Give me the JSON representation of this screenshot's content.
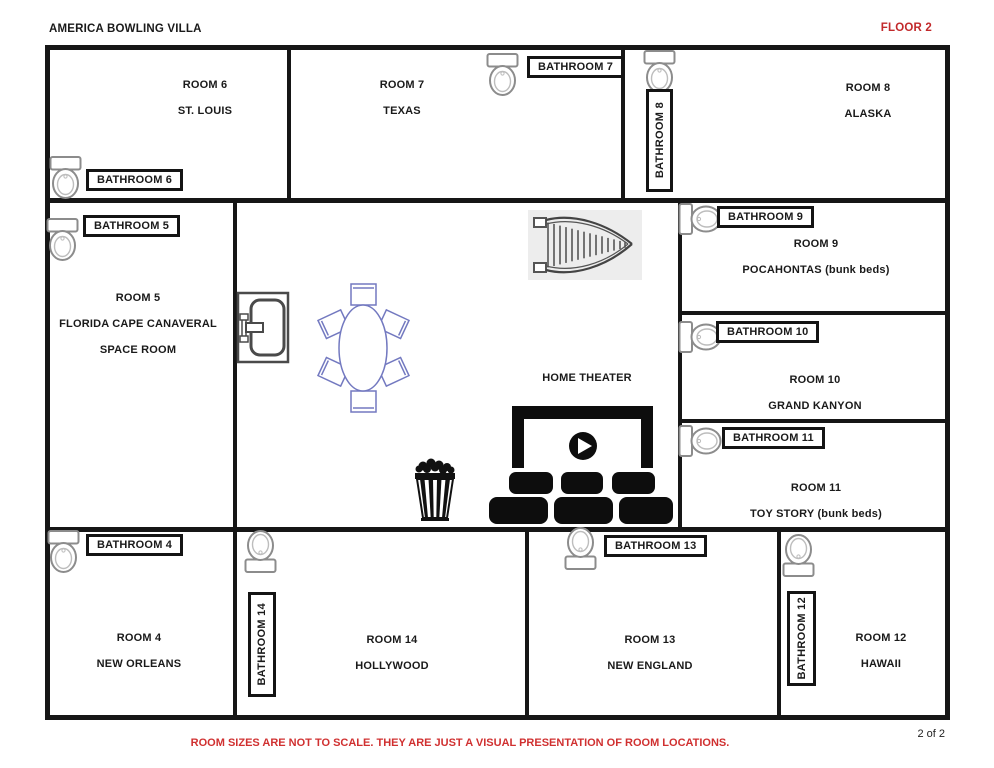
{
  "header": {
    "title": "AMERICA BOWLING VILLA",
    "floor": "FLOOR 2"
  },
  "rooms": {
    "room6": {
      "name": "ROOM 6",
      "theme": "ST. LOUIS"
    },
    "room7": {
      "name": "ROOM 7",
      "theme": "TEXAS"
    },
    "room8": {
      "name": "ROOM 8",
      "theme": "ALASKA"
    },
    "room5": {
      "name": "ROOM 5",
      "theme": "FLORIDA CAPE CANAVERAL",
      "theme2": "SPACE ROOM"
    },
    "room9": {
      "name": "ROOM 9",
      "theme": "POCAHONTAS (bunk beds)"
    },
    "room10": {
      "name": "ROOM 10",
      "theme": "GRAND KANYON"
    },
    "room11": {
      "name": "ROOM 11",
      "theme": "TOY STORY (bunk beds)"
    },
    "room4": {
      "name": "ROOM 4",
      "theme": "NEW ORLEANS"
    },
    "room14": {
      "name": "ROOM 14",
      "theme": "HOLLYWOOD"
    },
    "room13": {
      "name": "ROOM 13",
      "theme": "NEW ENGLAND"
    },
    "room12": {
      "name": "ROOM 12",
      "theme": "HAWAII"
    }
  },
  "bathrooms": {
    "b4": "BATHROOM 4",
    "b5": "BATHROOM 5",
    "b6": "BATHROOM 6",
    "b7": "BATHROOM 7",
    "b8": "BATHROOM 8",
    "b9": "BATHROOM 9",
    "b10": "BATHROOM 10",
    "b11": "BATHROOM 11",
    "b12": "BATHROOM 12",
    "b13": "BATHROOM 13",
    "b14": "BATHROOM 14"
  },
  "common_area": {
    "label": "HOME THEATER"
  },
  "footer": {
    "note": "ROOM SIZES ARE NOT TO SCALE. THEY ARE JUST A VISUAL PRESENTATION OF ROOM LOCATIONS.",
    "page": "2 of 2"
  },
  "icons": [
    "toilet-icon",
    "sink-icon",
    "stairs-icon",
    "dining-table-icon",
    "movie-screen-icon",
    "play-icon",
    "theater-seats-icon",
    "popcorn-icon"
  ],
  "colors": {
    "accent_red": "#C2292B",
    "wall_black": "#161616",
    "table_blue": "#7379C0",
    "fixture_gray": "#8C8C8C"
  }
}
